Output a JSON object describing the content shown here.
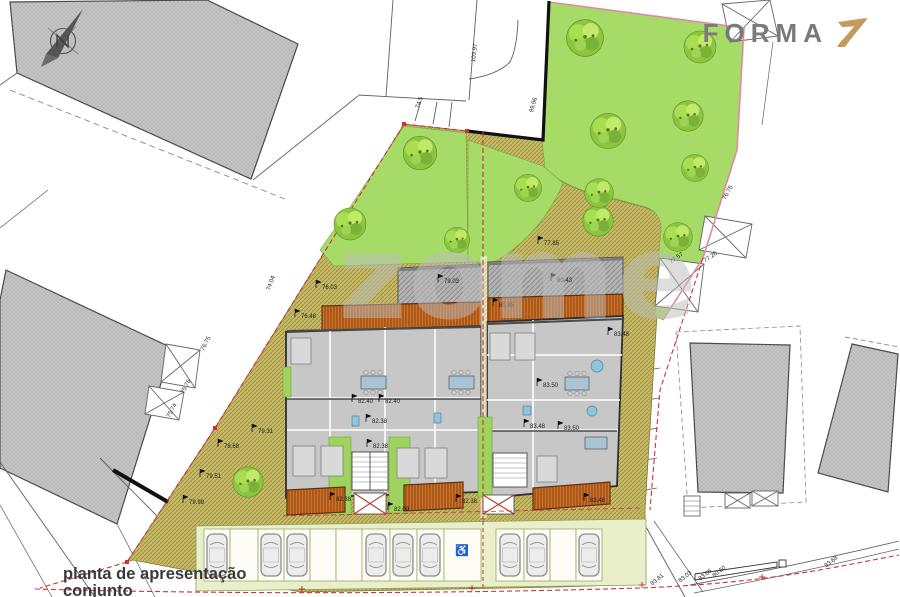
{
  "header": {
    "logo_text": "FORMA",
    "logo_mark": "Z"
  },
  "watermark": {
    "text": "zome"
  },
  "title_block": {
    "line1": "planta de apresentação",
    "line2": "conjunto"
  },
  "compass": {
    "letter": "N"
  },
  "colors": {
    "lawn": "#a6db68",
    "olive_path": "#c6ba66",
    "deck_orange": "#cf7127",
    "roof_gray": "#b3b3b3",
    "neighbor_gray": "#c9c9c9",
    "boundary_red": "#cc3333",
    "boundary_pink": "#e08aa2",
    "logo_gold": "#c49a5e",
    "floor_gray": "#c7c7c7",
    "courtyard_green": "#9ed45e"
  },
  "parking": {
    "handicap_symbol": "♿",
    "stalls": [
      [
        204,
        230
      ],
      [
        230,
        258
      ],
      [
        258,
        284
      ],
      [
        284,
        310
      ],
      [
        310,
        336
      ],
      [
        336,
        362
      ],
      [
        362,
        390
      ],
      [
        390,
        417
      ],
      [
        417,
        444
      ],
      [
        444,
        481
      ],
      [
        496,
        524
      ],
      [
        524,
        550
      ],
      [
        550,
        576
      ],
      [
        576,
        602
      ]
    ],
    "cars": [
      217,
      271,
      297,
      376,
      403,
      430,
      510,
      537,
      589
    ]
  },
  "labels": [
    {
      "t": "76.03",
      "x": 318,
      "y": 287,
      "f": 1
    },
    {
      "t": "76.48",
      "x": 297,
      "y": 316,
      "f": 1
    },
    {
      "t": "79.03",
      "x": 440,
      "y": 281,
      "f": 1
    },
    {
      "t": "80.43",
      "x": 553,
      "y": 280,
      "f": 1
    },
    {
      "t": "80.45",
      "x": 495,
      "y": 305,
      "f": 1
    },
    {
      "t": "77.85",
      "x": 540,
      "y": 243,
      "f": 1
    },
    {
      "t": "82.40",
      "x": 354,
      "y": 401,
      "f": 1
    },
    {
      "t": "82.40",
      "x": 381,
      "y": 401,
      "f": 1
    },
    {
      "t": "82.38",
      "x": 368,
      "y": 421,
      "f": 1
    },
    {
      "t": "82.38",
      "x": 369,
      "y": 446,
      "f": 1
    },
    {
      "t": "82.38",
      "x": 332,
      "y": 499,
      "f": 1
    },
    {
      "t": "82.38",
      "x": 458,
      "y": 501,
      "f": 1
    },
    {
      "t": "82.09",
      "x": 390,
      "y": 509,
      "f": 1
    },
    {
      "t": "83.48",
      "x": 610,
      "y": 334,
      "f": 1
    },
    {
      "t": "83.50",
      "x": 539,
      "y": 385,
      "f": 1
    },
    {
      "t": "83.48",
      "x": 526,
      "y": 426,
      "f": 1
    },
    {
      "t": "83.50",
      "x": 560,
      "y": 428,
      "f": 1
    },
    {
      "t": "83.48",
      "x": 586,
      "y": 500,
      "f": 1
    },
    {
      "t": "78.68",
      "x": 220,
      "y": 446,
      "f": 1
    },
    {
      "t": "79.31",
      "x": 254,
      "y": 431,
      "f": 1
    },
    {
      "t": "79.51",
      "x": 202,
      "y": 476,
      "f": 1
    },
    {
      "t": "79.99",
      "x": 185,
      "y": 502,
      "f": 1
    },
    {
      "t": "76.75",
      "x": 202,
      "y": 350,
      "r": -62
    },
    {
      "t": "75.76",
      "x": 182,
      "y": 393,
      "r": -62
    },
    {
      "t": "75.74",
      "x": 168,
      "y": 417,
      "r": -62
    },
    {
      "t": "74.04",
      "x": 268,
      "y": 290,
      "r": -70
    },
    {
      "t": "103.97",
      "x": 473,
      "y": 62,
      "r": -83
    },
    {
      "t": "99.96",
      "x": 531,
      "y": 112,
      "r": -75
    },
    {
      "t": "74.5",
      "x": 417,
      "y": 108,
      "r": -70
    },
    {
      "t": "76.76",
      "x": 724,
      "y": 199,
      "r": -62
    },
    {
      "t": "77.57",
      "x": 670,
      "y": 262,
      "r": -35
    },
    {
      "t": "77.26",
      "x": 704,
      "y": 261,
      "r": -35
    },
    {
      "t": "83.81",
      "x": 651,
      "y": 584,
      "r": -38
    },
    {
      "t": "83.03",
      "x": 679,
      "y": 581,
      "r": -38
    },
    {
      "t": "83.06",
      "x": 699,
      "y": 579,
      "r": -38
    },
    {
      "t": "80.60",
      "x": 713,
      "y": 576,
      "r": -38
    },
    {
      "t": "83.68",
      "x": 825,
      "y": 566,
      "r": -38
    }
  ],
  "trees": [
    [
      585,
      38,
      1.15
    ],
    [
      700,
      47,
      1.0
    ],
    [
      608,
      131,
      1.1
    ],
    [
      688,
      116,
      0.95
    ],
    [
      695,
      168,
      0.85
    ],
    [
      598,
      221,
      0.95
    ],
    [
      678,
      237,
      0.9
    ],
    [
      420,
      153,
      1.05
    ],
    [
      350,
      224,
      1.0
    ],
    [
      457,
      240,
      0.8
    ],
    [
      528,
      188,
      0.85
    ],
    [
      599,
      193,
      0.9
    ],
    [
      248,
      482,
      0.95
    ]
  ]
}
